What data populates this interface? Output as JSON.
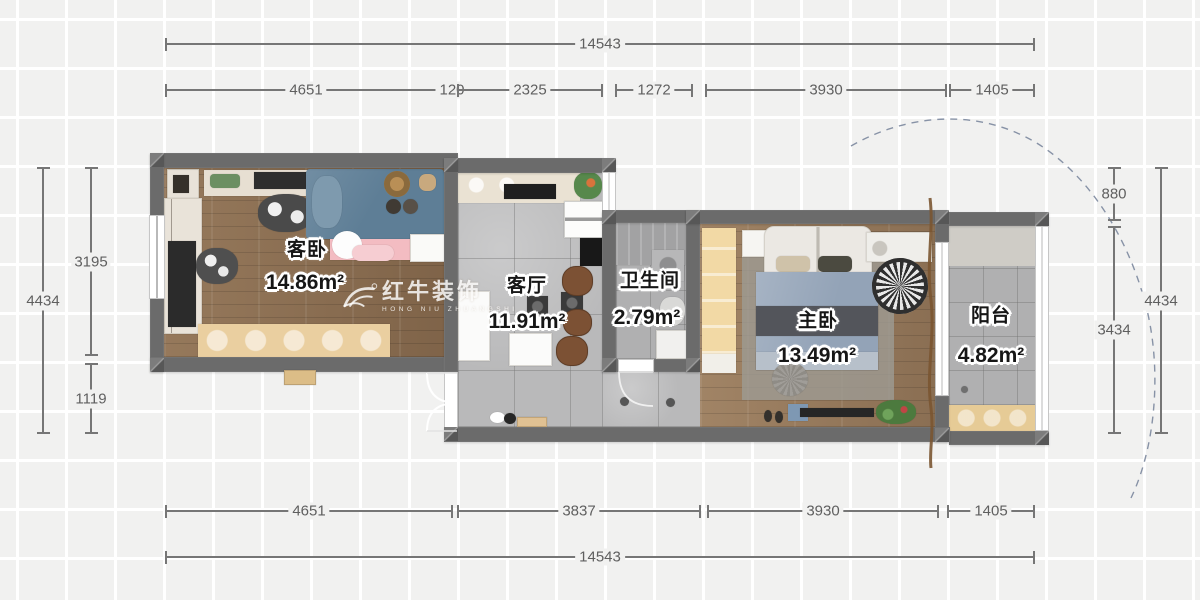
{
  "title": "apartment-floor-plan",
  "watermark": {
    "brand": "红牛装饰",
    "sub": "HONG NIU ZHUANGSHI"
  },
  "rooms": [
    {
      "id": "guest-bedroom",
      "name": "客卧",
      "area": "14.86m²"
    },
    {
      "id": "living-room",
      "name": "客厅",
      "area": "11.91m²"
    },
    {
      "id": "bathroom",
      "name": "卫生间",
      "area": "2.79m²"
    },
    {
      "id": "master-bedroom",
      "name": "主卧",
      "area": "13.49m²"
    },
    {
      "id": "balcony",
      "name": "阳台",
      "area": "4.82m²"
    }
  ],
  "dims": {
    "top_total": "14543",
    "top_segments": [
      "4651",
      "120",
      "2325",
      "1272",
      "3930",
      "1405"
    ],
    "bottom_segments": [
      "4651",
      "3837",
      "3930",
      "1405"
    ],
    "bottom_total": "14543",
    "left_outer": "4434",
    "left_upper": "3195",
    "left_lower": "1119",
    "right_upper": "880",
    "right_lower": "3434",
    "right_outer": "4434"
  },
  "palette": {
    "wall": "#6b6b6b",
    "wood_floor": "#8a6c4f",
    "tile_floor": "#b9b9ba",
    "guest_bed_blue": "#5e7e96",
    "guest_bed_pink": "#f3bcc2",
    "cabinet_tan": "#eacfa0",
    "wardrobe_yellow": "#f2d9a5",
    "bed_blanket_blue": "#93a3b7",
    "chair_brown": "#7c5134",
    "plant_green": "#57884c",
    "dim_line": "#767676",
    "arc_dashed": "#8792a6",
    "background": "#f1f1f0"
  }
}
